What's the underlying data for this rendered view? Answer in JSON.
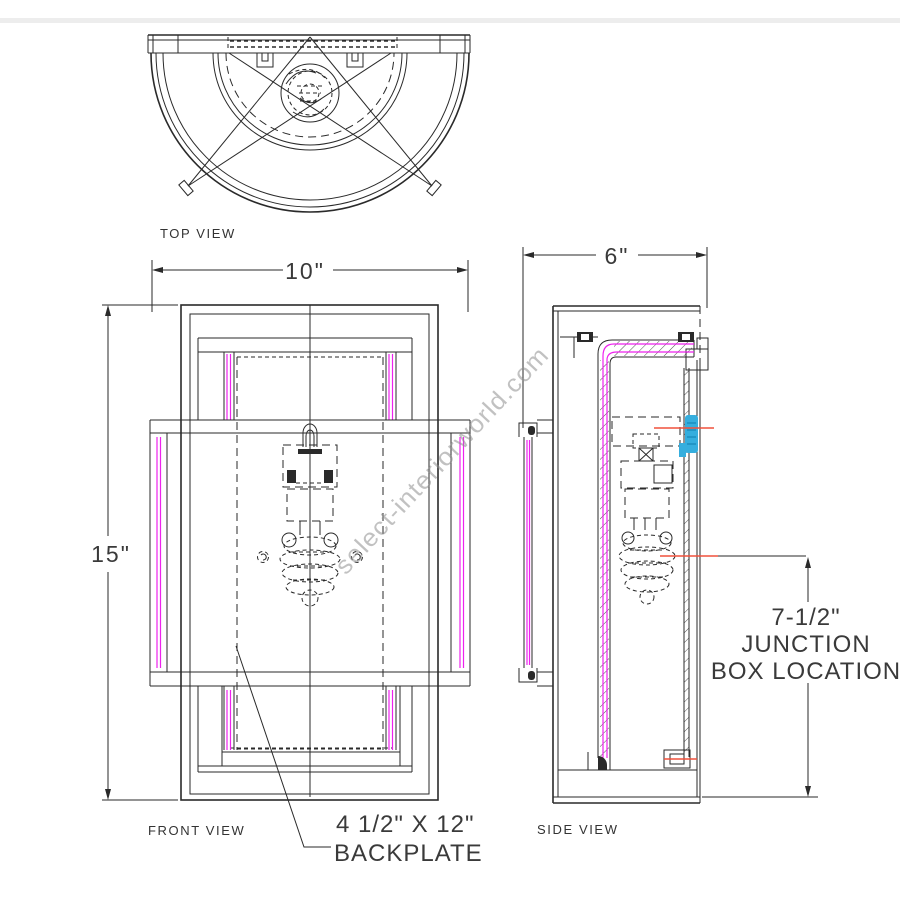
{
  "diagram": {
    "watermark": "select-interiorworld.com",
    "views": {
      "top": {
        "label": "TOP VIEW"
      },
      "front": {
        "label": "FRONT VIEW",
        "width_dim": "10\"",
        "height_dim": "15\""
      },
      "side": {
        "label": "SIDE VIEW",
        "depth_dim": "6\""
      }
    },
    "annotations": {
      "junction": {
        "line1": "7-1/2\"",
        "line2": "JUNCTION",
        "line3": "BOX LOCATION"
      },
      "backplate": {
        "line1": "4 1/2\" X 12\"",
        "line2": "BACKPLATE"
      }
    },
    "colors": {
      "line": "#2a2a2a",
      "glass": "#ee22ee",
      "hardware": "#35aede",
      "leader": "#f0503c",
      "watermark": "#8f8f8f"
    }
  }
}
